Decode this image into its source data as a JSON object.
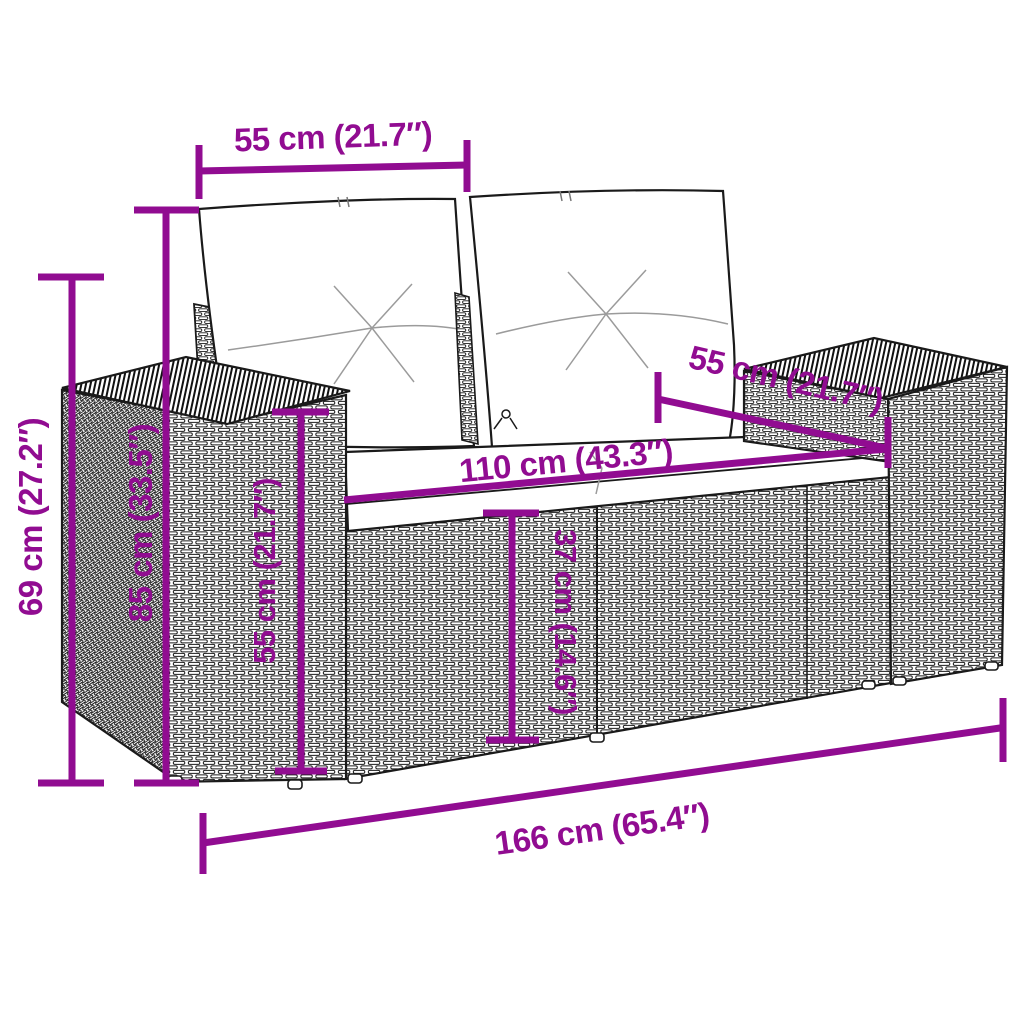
{
  "accent_color": "#910C91",
  "line_art_color": "#1A1A1A",
  "background_color": "#FFFFFF",
  "subject": "poly-rattan-2-seater-garden-sofa-with-cushions",
  "dims": {
    "back_cushion_width": {
      "label": "55 cm (21.7″)",
      "cm": 55,
      "inch": 21.7
    },
    "seat_depth": {
      "label": "55 cm (21.7″)",
      "cm": 55,
      "inch": 21.7
    },
    "seat_width": {
      "label": "110 cm (43.3″)",
      "cm": 110,
      "inch": 43.3
    },
    "arm_height": {
      "label": "69 cm (27.2″)",
      "cm": 69,
      "inch": 27.2
    },
    "back_height": {
      "label": "85 cm (33.5″)",
      "cm": 85,
      "inch": 33.5
    },
    "armrest_front_height": {
      "label": "55 cm (21.7″)",
      "cm": 55,
      "inch": 21.7
    },
    "seat_height": {
      "label": "37 cm (14.6″)",
      "cm": 37,
      "inch": 14.6
    },
    "total_width": {
      "label": "166 cm (65.4″)",
      "cm": 166,
      "inch": 65.4
    }
  }
}
